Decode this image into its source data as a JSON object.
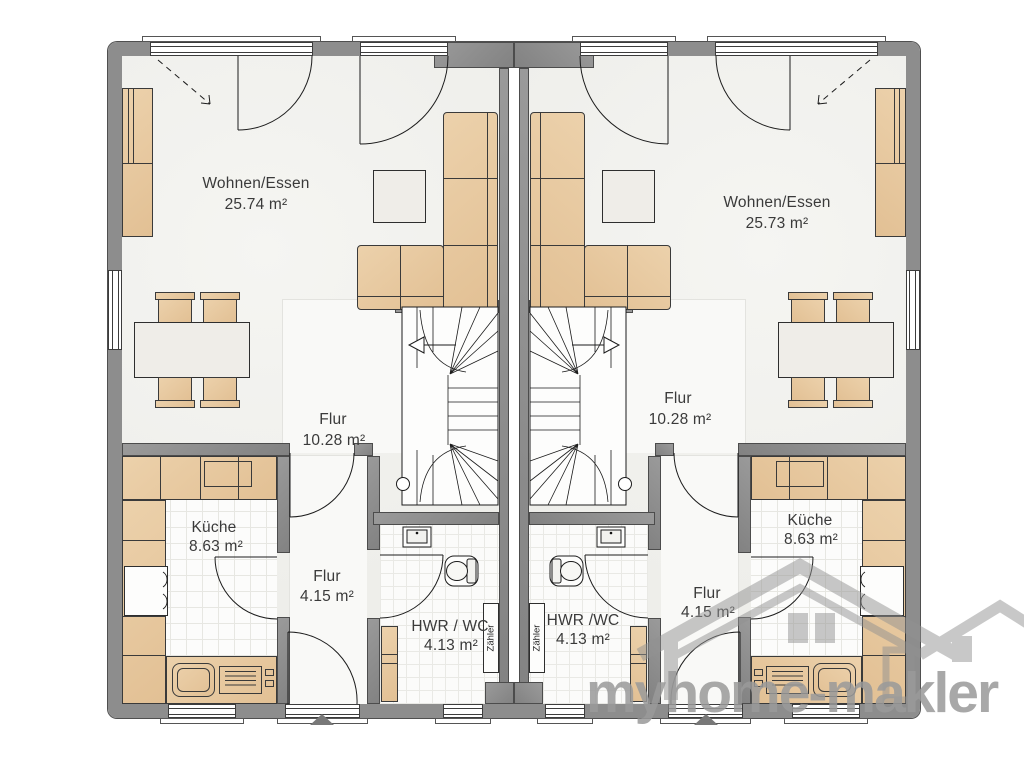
{
  "plan_type": "duplex-ground-floor",
  "watermark": {
    "brand": "myhome-makler"
  },
  "units": {
    "left": {
      "wohnen_essen": {
        "name": "Wohnen/Essen",
        "area": "25.74 m²"
      },
      "flur": {
        "name": "Flur",
        "area": "10.28 m²"
      },
      "kueche": {
        "name": "Küche",
        "area": "8.63 m²"
      },
      "flur2": {
        "name": "Flur",
        "area": "4.15 m²"
      },
      "hwr": {
        "name": "HWR / WC",
        "area": "4.13 m²"
      },
      "meter": "Zähler"
    },
    "right": {
      "wohnen_essen": {
        "name": "Wohnen/Essen",
        "area": "25.73 m²"
      },
      "flur": {
        "name": "Flur",
        "area": "10.28 m²"
      },
      "kueche": {
        "name": "Küche",
        "area": "8.63 m²"
      },
      "flur2": {
        "name": "Flur",
        "area": "4.15 m²"
      },
      "hwr": {
        "name": "HWR /WC",
        "area": "4.13 m²"
      },
      "meter": "Zähler"
    }
  },
  "colors": {
    "wall": "#8d8d8d",
    "furniture": "#e7c9a2",
    "watermark": "#9a9a9a"
  }
}
